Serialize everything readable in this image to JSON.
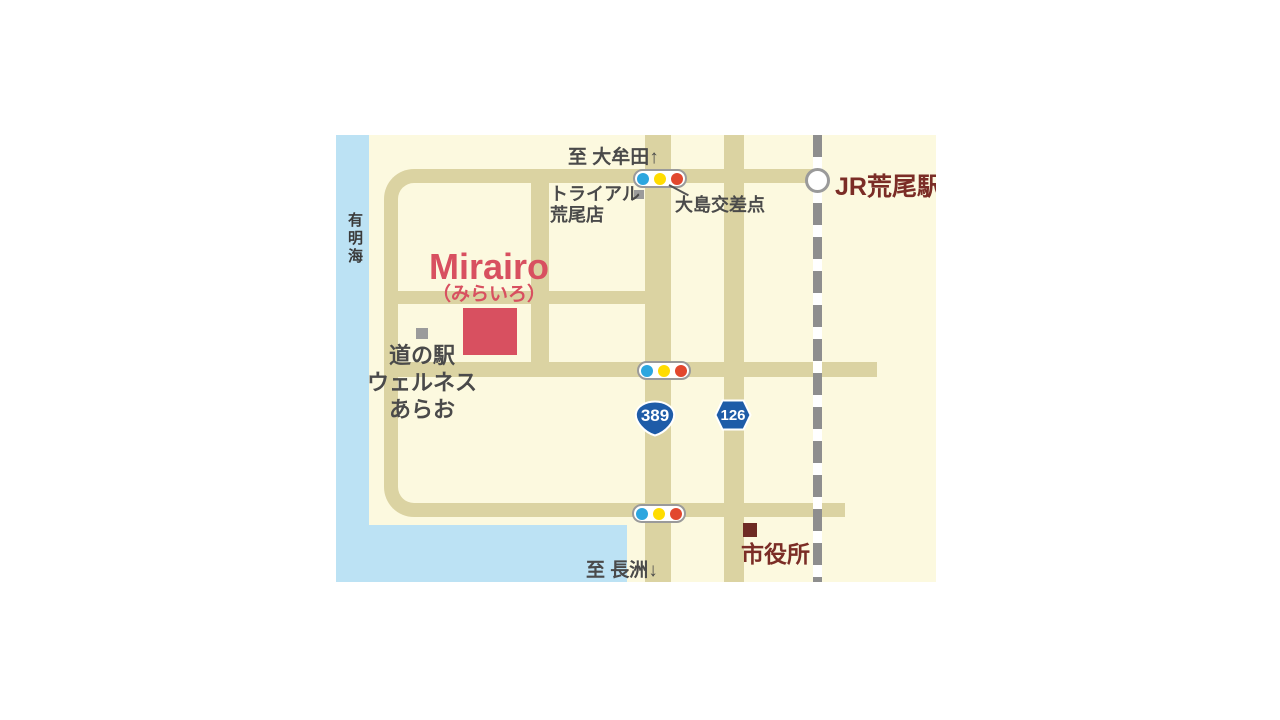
{
  "map": {
    "labels": {
      "sea": "有明海",
      "to_north": "至 大牟田↑",
      "to_south": "至 長洲↓",
      "station": "JR荒尾駅",
      "intersection": "大島交差点",
      "store_line1": "トライアル",
      "store_line2": "荒尾店",
      "venue_name": "Mirairo",
      "venue_kana": "（みらいろ）",
      "roadside_station_line1": "道の駅",
      "roadside_station_line2": "ウェルネス",
      "roadside_station_line3": "あらお",
      "city_hall": "市役所"
    },
    "routes": [
      {
        "number": "389"
      },
      {
        "number": "126"
      }
    ],
    "colors": {
      "map_background": "#FCF9DF",
      "sea": "#BCE2F4",
      "road": "#DBD3A2",
      "railway_gray": "#8E8E8E",
      "venue_red": "#D85060",
      "maroon_text": "#7B2D26",
      "gray_text": "#4A4A4A",
      "route_badge_blue": "#1E5CA8",
      "traffic_blue": "#2CA6DF",
      "traffic_yellow": "#FFDC00",
      "traffic_red": "#E2472E",
      "marker_gray": "#9B9B9B"
    }
  }
}
